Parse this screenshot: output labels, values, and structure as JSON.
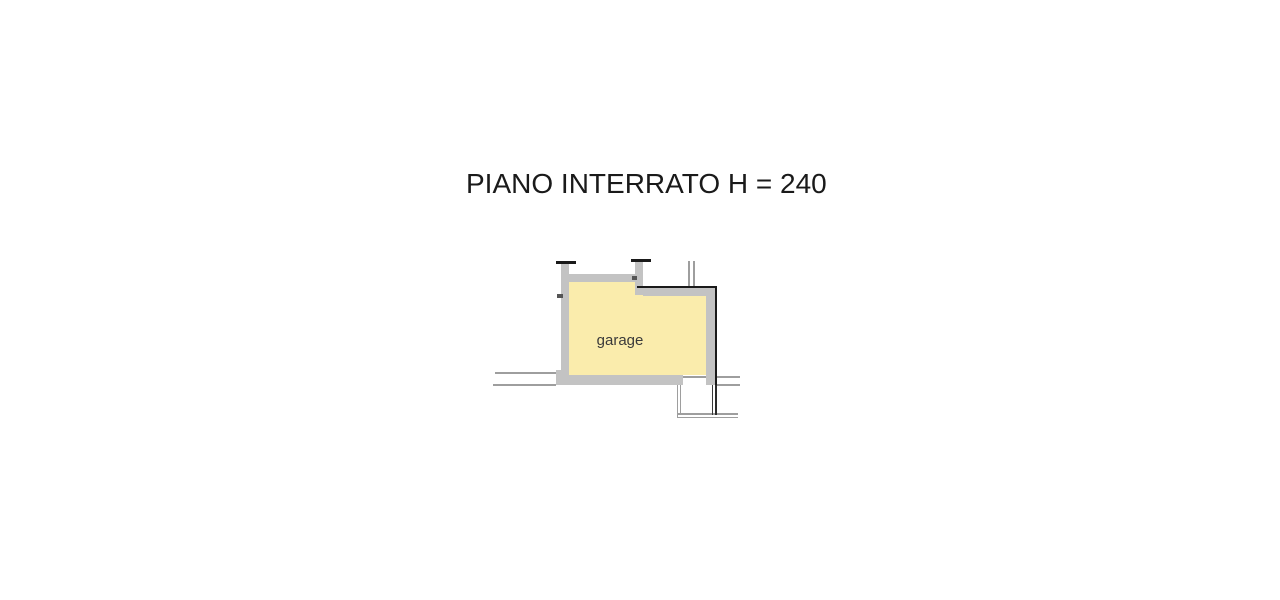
{
  "title": "PIANO INTERRATO H = 240",
  "floor_plan": {
    "room_label": "garage",
    "description": "basement floor plan with single garage room, door opening at bottom right leading to a ramp/shaft outline, vent pipe lines at top right, section lines extending left and right"
  },
  "colors": {
    "background": "#FFFFFF",
    "room_fill": "#FAECAC",
    "wall_gray": "#C3C3C3",
    "outline_black": "#1A1A1A",
    "thin_line_gray": "#9E9E9E",
    "label_text": "#3A3A3A"
  }
}
